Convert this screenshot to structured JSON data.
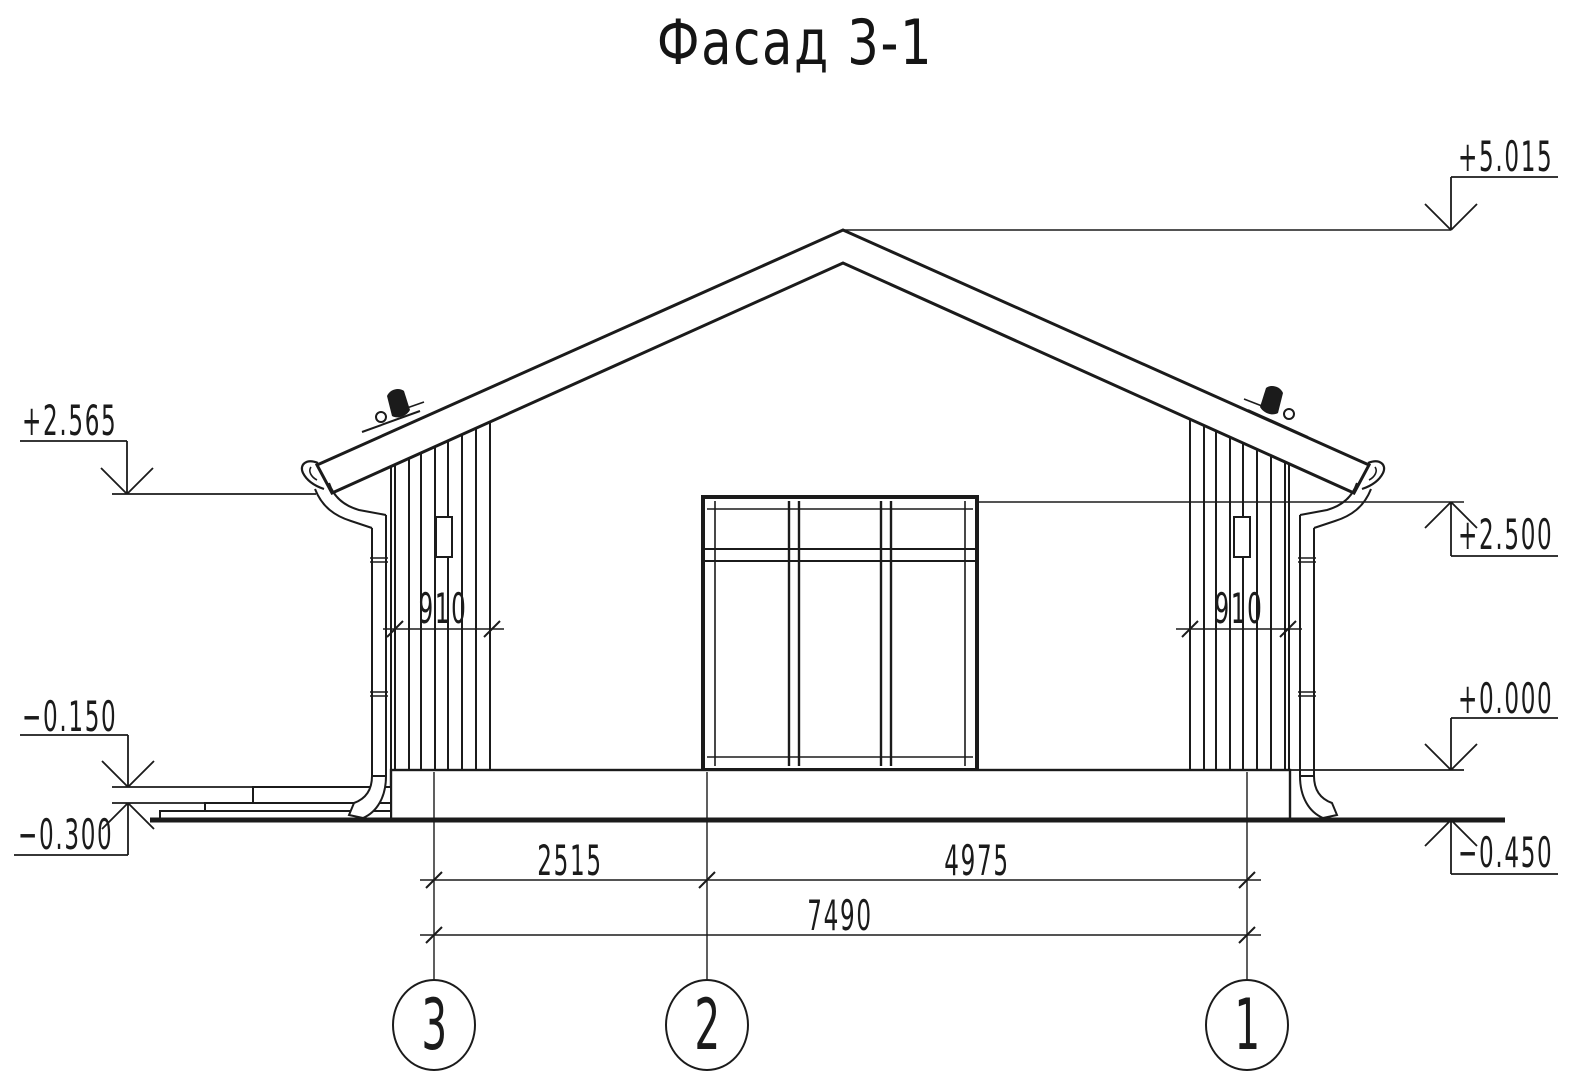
{
  "title": "Фасад 3-1",
  "elevation_marks": {
    "roof_peak": "+5.015",
    "left_eave": "+2.565",
    "lintel": "+2.500",
    "floor_zero": "+0.000",
    "porch": "−0.150",
    "left_grade": "−0.300",
    "right_grade": "−0.450"
  },
  "dimensions": {
    "left_siding_width": "910",
    "right_siding_width": "910",
    "axis_3_to_2": "2515",
    "axis_2_to_1": "4975",
    "overall": "7490"
  },
  "axes": [
    {
      "label": "3"
    },
    {
      "label": "2"
    },
    {
      "label": "1"
    }
  ],
  "colors": {
    "ink": "#1b1b1b",
    "paper": "#ffffff"
  }
}
